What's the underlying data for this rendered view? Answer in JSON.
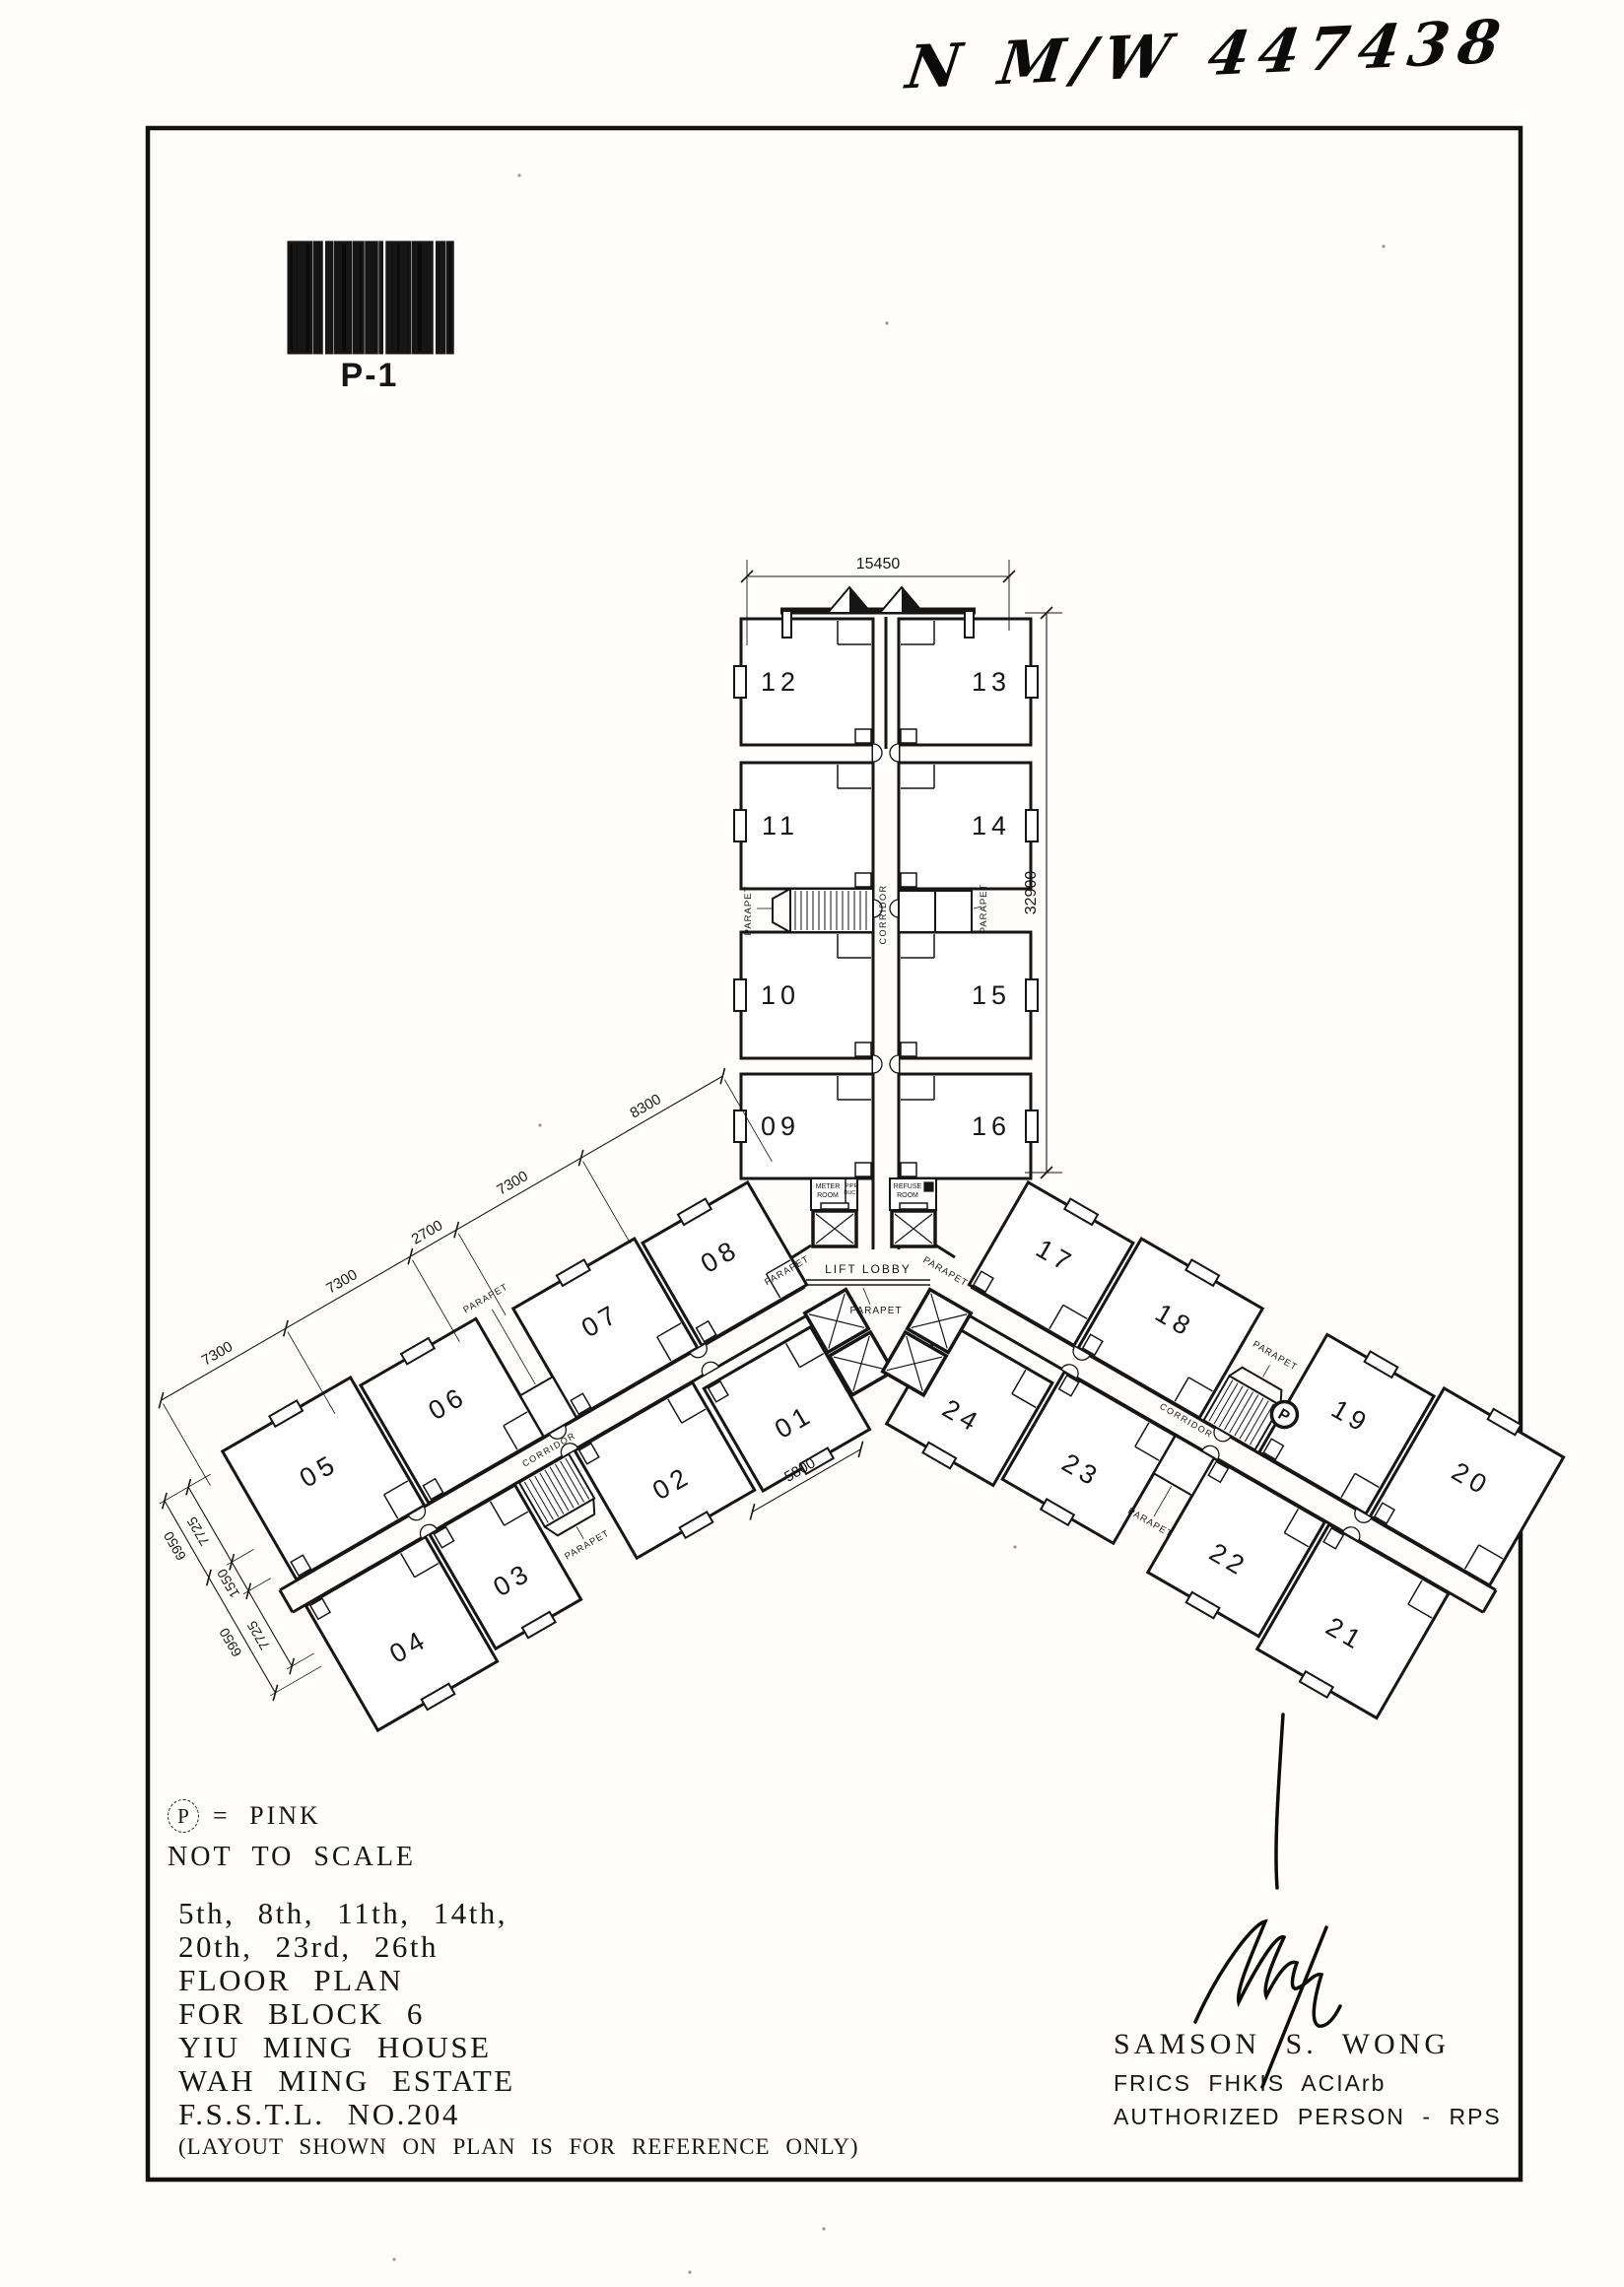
{
  "page": {
    "handwritten_ref": "N M/W 447438",
    "barcode_label": "P-1"
  },
  "legend": {
    "marker_symbol": "P",
    "marker_meaning": "=  PINK",
    "scale_note": "NOT TO SCALE"
  },
  "title_block": {
    "lines": [
      "5th, 8th, 11th, 14th,",
      "20th, 23rd, 26th",
      "FLOOR PLAN",
      "FOR BLOCK 6",
      "YIU MING HOUSE",
      "WAH MING ESTATE",
      "F.S.S.T.L. NO.204"
    ],
    "note": "(LAYOUT SHOWN ON PLAN IS FOR REFERENCE ONLY)"
  },
  "signature_block": {
    "name": "SAMSON S. WONG",
    "credentials": "FRICS FHKIS ACIArb",
    "title": "AUTHORIZED PERSON - RPS"
  },
  "plan": {
    "units": {
      "north_left": [
        "12",
        "11",
        "10",
        "09"
      ],
      "north_right": [
        "13",
        "14",
        "15",
        "16"
      ],
      "west_upper": [
        "08",
        "07",
        "06",
        "05"
      ],
      "west_lower": [
        "01",
        "02",
        "03",
        "04"
      ],
      "east_upper": [
        "17",
        "18",
        "19",
        "20"
      ],
      "east_lower": [
        "24",
        "23",
        "22",
        "21"
      ]
    },
    "labels": {
      "lift_lobby": "LIFT LOBBY",
      "corridor": "CORRIDOR",
      "parapet": "PARAPET",
      "meter_room": [
        "METER",
        "ROOM"
      ],
      "pipe_duct": [
        "PIPE",
        "DUCT"
      ],
      "refuse_room": [
        "REFUSE",
        "ROOM"
      ],
      "marker": "P"
    },
    "dimensions": {
      "overall_width": "15450",
      "overall_length": "32900",
      "west_wing_chain": [
        "7300",
        "7300",
        "2700",
        "7300",
        "8300"
      ],
      "unit_01": "5800",
      "west_end_chain_inner": [
        "7725",
        "1550",
        "7725"
      ],
      "west_end_chain_outer": [
        "6950",
        "6950"
      ]
    }
  }
}
